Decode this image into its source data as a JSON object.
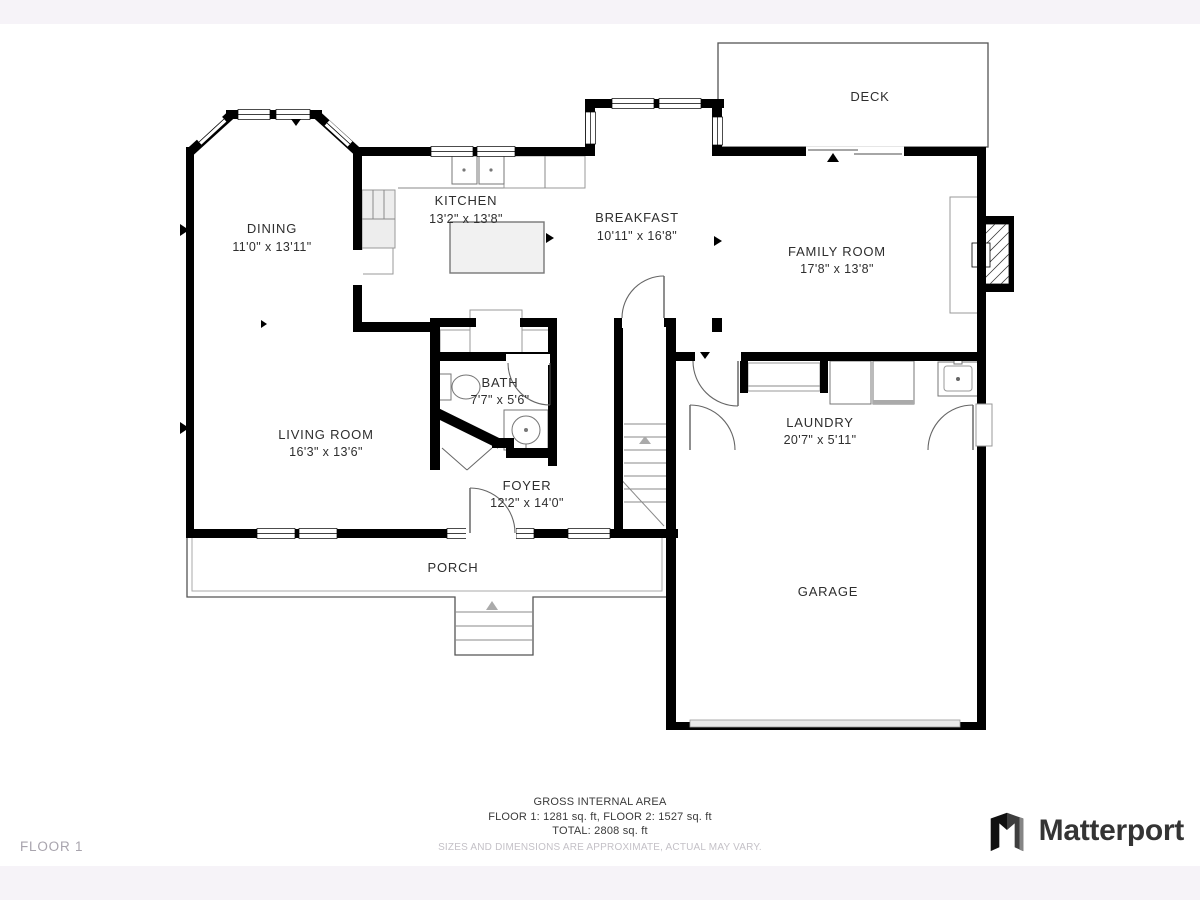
{
  "page": {
    "background": "#ffffff",
    "strip_color": "#f6f3f8",
    "floor_label": "FLOOR 1"
  },
  "rooms": {
    "deck": {
      "name": "DECK",
      "dims": ""
    },
    "dining": {
      "name": "DINING",
      "dims": "11'0\" x 13'11\""
    },
    "kitchen": {
      "name": "KITCHEN",
      "dims": "13'2\" x 13'8\""
    },
    "breakfast": {
      "name": "BREAKFAST",
      "dims": "10'11\" x 16'8\""
    },
    "family_room": {
      "name": "FAMILY ROOM",
      "dims": "17'8\" x 13'8\""
    },
    "bath": {
      "name": "BATH",
      "dims": "7'7\" x 5'6\""
    },
    "living_room": {
      "name": "LIVING ROOM",
      "dims": "16'3\" x 13'6\""
    },
    "foyer": {
      "name": "FOYER",
      "dims": "12'2\" x 14'0\""
    },
    "laundry": {
      "name": "LAUNDRY",
      "dims": "20'7\" x 5'11\""
    },
    "porch": {
      "name": "PORCH",
      "dims": ""
    },
    "garage": {
      "name": "GARAGE",
      "dims": ""
    }
  },
  "footer": {
    "title": "GROSS INTERNAL AREA",
    "floors": "FLOOR 1: 1281 sq. ft, FLOOR 2: 1527 sq. ft",
    "total": "TOTAL: 2808 sq. ft",
    "disclaimer": "SIZES AND DIMENSIONS ARE APPROXIMATE, ACTUAL MAY VARY."
  },
  "branding": {
    "logo_text": "Matterport",
    "logo_icon": "matterport-logo-icon"
  },
  "colors": {
    "wall": "#000000",
    "thin_line": "#555555",
    "label_text": "#2e2e2e",
    "muted_text": "#c4c1c7",
    "logo_text": "#343434"
  }
}
